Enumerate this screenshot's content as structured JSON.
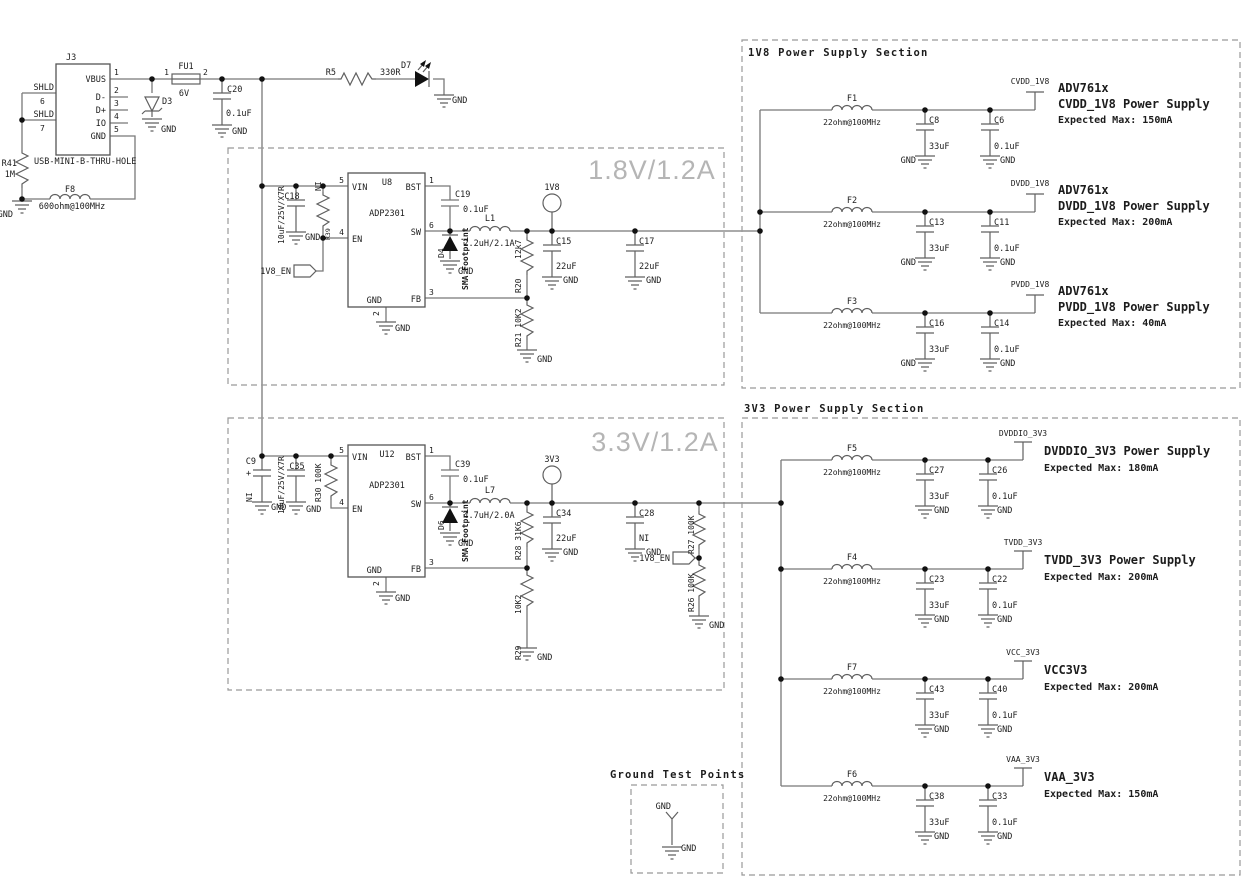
{
  "gnd": "GND",
  "titles": {
    "reg18": "1.8V/1.2A",
    "reg33": "3.3V/1.2A",
    "sec1v8": "1V8 Power Supply Section",
    "sec3v3": "3V3 Power Supply Section",
    "gndtp": "Ground Test Points"
  },
  "usb": {
    "ref": "J3",
    "footprint": "USB-MINI-B-THRU-HOLE",
    "vbus": "VBUS",
    "dm": "D-",
    "dp": "D+",
    "io": "IO",
    "gnd": "GND",
    "shld": "SHLD",
    "n1": "1",
    "n2": "2",
    "n3": "3",
    "n4": "4",
    "n5": "5",
    "n6": "6",
    "n7": "7"
  },
  "input": {
    "r41": {
      "ref": "R41",
      "val": "1M"
    },
    "f8": {
      "ref": "F8",
      "val": "600ohm@100MHz"
    },
    "d3": {
      "ref": "D3"
    },
    "fu1": {
      "ref": "FU1",
      "val": "6V",
      "p1": "1",
      "p2": "2"
    },
    "c20": {
      "ref": "C20",
      "val": "0.1uF"
    },
    "r5": {
      "ref": "R5",
      "val": "330R"
    },
    "d7": {
      "ref": "D7"
    }
  },
  "adp": {
    "part": "ADP2301",
    "vin": "VIN",
    "en": "EN",
    "gnd": "GND",
    "bst": "BST",
    "sw": "SW",
    "fb": "FB",
    "n1": "1",
    "n2": "2",
    "n3": "3",
    "n4": "4",
    "n5": "5",
    "n6": "6"
  },
  "reg18": {
    "u": "U8",
    "c18": {
      "ref": "C18",
      "val": "10uF/25V/X7R"
    },
    "rni": {
      "ref": "R39",
      "val": "NI"
    },
    "en_flag": "1V8_EN",
    "c19": {
      "ref": "C19",
      "val": "0.1uF"
    },
    "d4": {
      "ref": "D4",
      "note": "SMA Footprint"
    },
    "l1": {
      "ref": "L1",
      "val": "2.2uH/2.1A"
    },
    "tp": "1V8",
    "c15": {
      "ref": "C15",
      "val": "22uF"
    },
    "c17": {
      "ref": "C17",
      "val": "22uF"
    },
    "r20": {
      "ref": "R20",
      "val": "12k7"
    },
    "r21": {
      "label": "R21 10K2"
    }
  },
  "reg33": {
    "u": "U12",
    "c9": {
      "ref": "C9",
      "val": "NI",
      "plus": "+"
    },
    "c35": {
      "ref": "C35",
      "val": "10uF/25V/X7R"
    },
    "r30": {
      "label": "R30 100K"
    },
    "c39": {
      "ref": "C39",
      "val": "0.1uF"
    },
    "d6": {
      "ref": "D6",
      "note": "SMA Footprint"
    },
    "l7": {
      "ref": "L7",
      "val": "4.7uH/2.0A"
    },
    "tp": "3V3",
    "c34": {
      "ref": "C34",
      "val": "22uF"
    },
    "c28": {
      "ref": "C28",
      "val": "NI"
    },
    "r28": {
      "label": "R28 31K6"
    },
    "r29": {
      "ref": "R29",
      "val": "10K2"
    },
    "r27": {
      "label": "R27 100K"
    },
    "r26": {
      "label": "R26 100K"
    },
    "en_flag": "1V8_EN"
  },
  "sec1v8_rows": [
    {
      "fer": "F1",
      "ferval": "22ohm@100MHz",
      "c1": "C8",
      "c1v": "33uF",
      "c2": "C6",
      "c2v": "0.1uF",
      "net": "CVDD_1V8",
      "d1": "ADV761x",
      "d2": "CVDD_1V8 Power Supply",
      "d3": "Expected Max: 150mA"
    },
    {
      "fer": "F2",
      "ferval": "22ohm@100MHz",
      "c1": "C13",
      "c1v": "33uF",
      "c2": "C11",
      "c2v": "0.1uF",
      "net": "DVDD_1V8",
      "d1": "ADV761x",
      "d2": "DVDD_1V8 Power Supply",
      "d3": "Expected Max: 200mA"
    },
    {
      "fer": "F3",
      "ferval": "22ohm@100MHz",
      "c1": "C16",
      "c1v": "33uF",
      "c2": "C14",
      "c2v": "0.1uF",
      "net": "PVDD_1V8",
      "d1": "ADV761x",
      "d2": "PVDD_1V8 Power Supply",
      "d3": "Expected Max: 40mA"
    }
  ],
  "sec3v3_rows": [
    {
      "fer": "F5",
      "ferval": "22ohm@100MHz",
      "c1": "C27",
      "c1v": "33uF",
      "c2": "C26",
      "c2v": "0.1uF",
      "net": "DVDDIO_3V3",
      "d1": "DVDDIO_3V3 Power Supply",
      "d2": "Expected Max: 180mA"
    },
    {
      "fer": "F4",
      "ferval": "22ohm@100MHz",
      "c1": "C23",
      "c1v": "33uF",
      "c2": "C22",
      "c2v": "0.1uF",
      "net": "TVDD_3V3",
      "d1": "TVDD_3V3 Power Supply",
      "d2": "Expected Max: 200mA"
    },
    {
      "fer": "F7",
      "ferval": "22ohm@100MHz",
      "c1": "C43",
      "c1v": "33uF",
      "c2": "C40",
      "c2v": "0.1uF",
      "net": "VCC_3V3",
      "d1": "VCC3V3",
      "d2": "Expected Max: 200mA"
    },
    {
      "fer": "F6",
      "ferval": "22ohm@100MHz",
      "c1": "C38",
      "c1v": "33uF",
      "c2": "C33",
      "c2v": "0.1uF",
      "net": "VAA_3V3",
      "d1": "VAA_3V3",
      "d2": "Expected Max: 150mA"
    }
  ],
  "gndtp": {
    "tp_label": "GND",
    "gnd_label": "GND"
  }
}
